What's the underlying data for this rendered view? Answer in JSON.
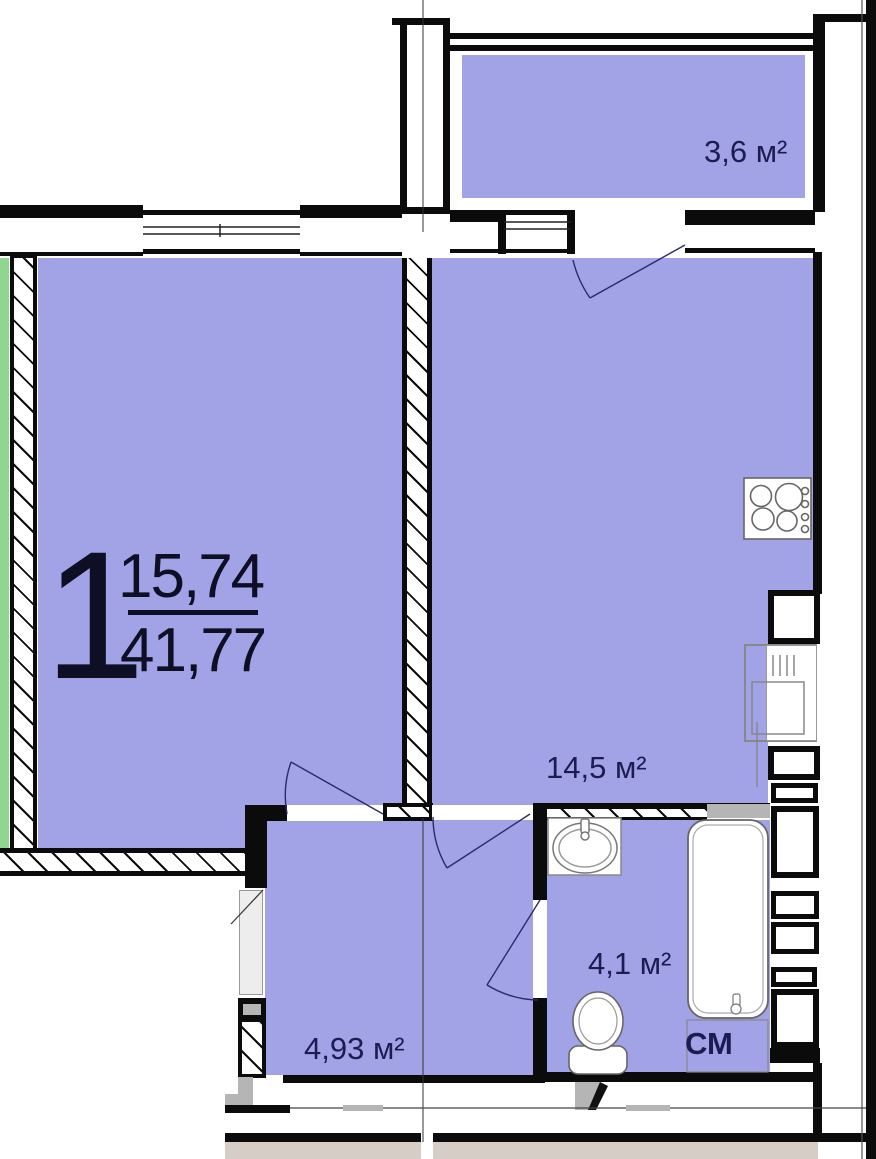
{
  "unit": {
    "number": "1",
    "living_area": "15,74",
    "total_area": "41,77"
  },
  "rooms": {
    "balcony": "3,6 м²",
    "kitchen": "14,5 м²",
    "bathroom": "4,1 м²",
    "hallway": "4,93 м²",
    "washing_machine": "СМ"
  },
  "colors": {
    "room_fill": "#a2a3e6",
    "facade_green": "#8fd78f",
    "neighbor_tan": "#d6cdc7",
    "gray_detail": "#b5b5b5",
    "wall_black": "#0b0b0b",
    "label_navy": "#1c1c52",
    "number_dark": "#0e0e24"
  }
}
